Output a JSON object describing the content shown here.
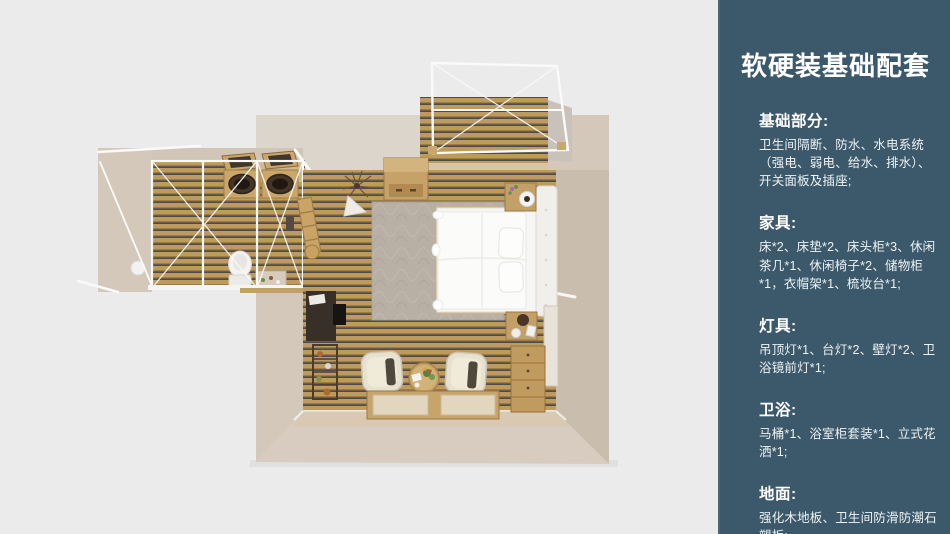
{
  "colors": {
    "page_bg": "#ebebec",
    "sidebar_bg": "#3c596b",
    "sidebar_edge": "#4d6274",
    "wall": "#d3c8ba",
    "wall_dark": "#c9bdae",
    "wall_light": "#dcd5cc",
    "wall_bottom": "#d7ccbf",
    "floor_tan": "#bf9a5d",
    "floor_line_dark": "#4b4c4f",
    "rug": "#b8afa5",
    "bed_white": "#f6f6f4",
    "wood_furniture": "#c2a069",
    "frame_white": "#fafaf8",
    "dark_cabinet": "#382f28"
  },
  "sidebar": {
    "title": "软硬装基础配套",
    "sections": [
      {
        "heading": "基础部分:",
        "body": "卫生间隔断、防水、水电系统（强电、弱电、给水、排水）、开关面板及插座;"
      },
      {
        "heading": "家具:",
        "body": "床*2、床垫*2、床头柜*3、休闲茶几*1、休闲椅子*2、储物柜*1，衣帽架*1、梳妆台*1;"
      },
      {
        "heading": "灯具:",
        "body": "吊顶灯*1、台灯*2、壁灯*2、卫浴镜前灯*1;"
      },
      {
        "heading": "卫浴:",
        "body": "马桶*1、浴室柜套装*1、立式花洒*1;"
      },
      {
        "heading": "地面:",
        "body": "强化木地板、卫生间防滑防潮石塑板;"
      }
    ]
  }
}
